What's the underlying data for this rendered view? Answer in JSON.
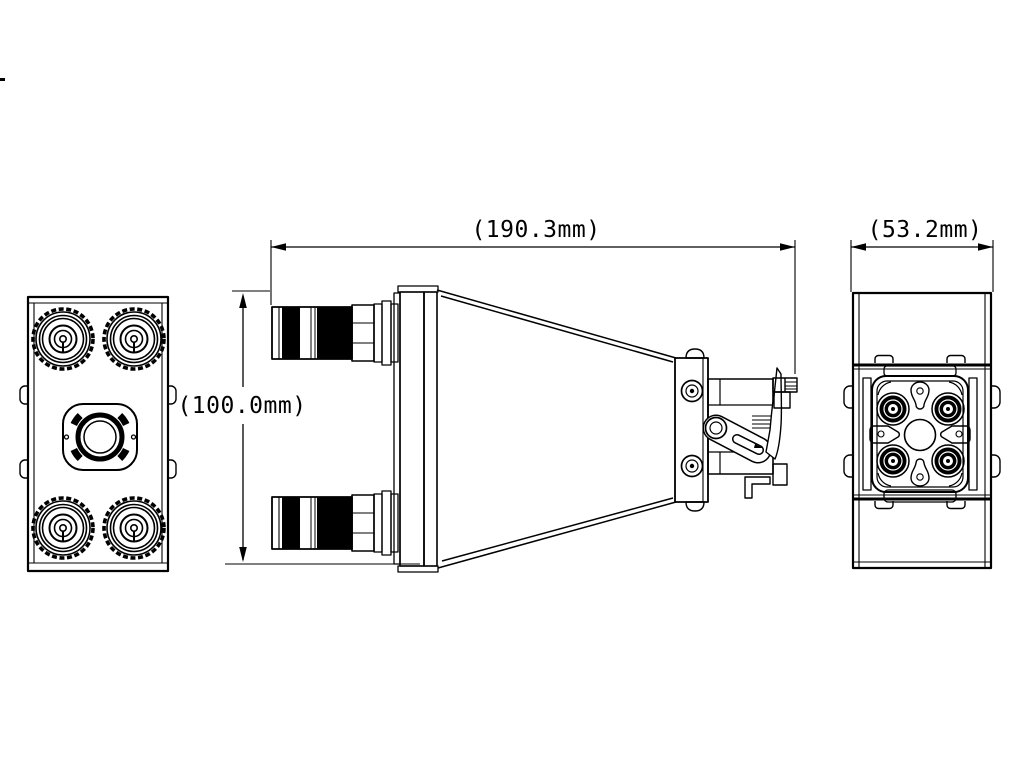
{
  "drawing": {
    "dimensions": {
      "side_view_width": "(190.3mm)",
      "end_view_width": "(53.2mm)",
      "front_height": "(100.0mm)"
    },
    "colors": {
      "line": "#000000",
      "background": "#ffffff"
    }
  }
}
